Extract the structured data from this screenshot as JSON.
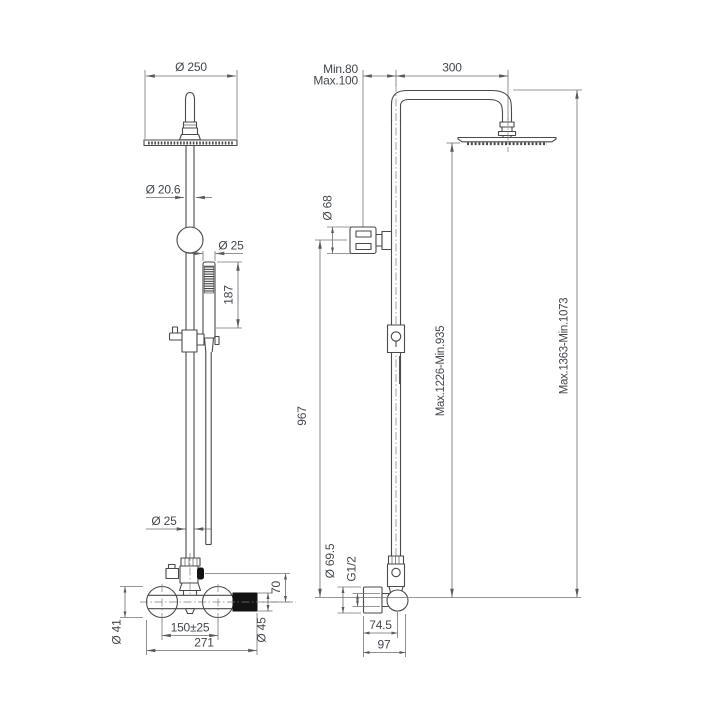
{
  "drawing": {
    "kind": "shower-column-dimensional-drawing",
    "colors": {
      "background": "#ffffff",
      "object_line": "#4a4a4a",
      "dimension_line": "#6a6a6a",
      "text": "#42474c",
      "handle_fill": "#121212"
    }
  },
  "dims": {
    "front_head_diameter": "Ø 250",
    "front_pipe_diameter": "Ø 20.6",
    "front_handshower_width": "Ø 25",
    "front_handshower_length": "187",
    "front_column_diameter": "Ø 25",
    "front_union_diameter": "Ø 41",
    "front_inlet_spacing": "150±25",
    "front_body_width": "271",
    "front_handle_diameter": "Ø 45",
    "front_diverter_offset": "70",
    "side_wall_clearance_min": "Min.80",
    "side_wall_clearance_max": "Max.100",
    "side_arm_reach": "300",
    "side_handshower_head_diameter": "Ø 68",
    "side_column_height": "967",
    "side_head_height_range": "Max.1226-Min.935",
    "side_total_height_range": "Max.1363-Min.1073",
    "side_flange_diameter": "Ø 69.5",
    "side_thread": "G1/2",
    "side_wall_to_axis": "74.5",
    "side_wall_to_front": "97"
  }
}
